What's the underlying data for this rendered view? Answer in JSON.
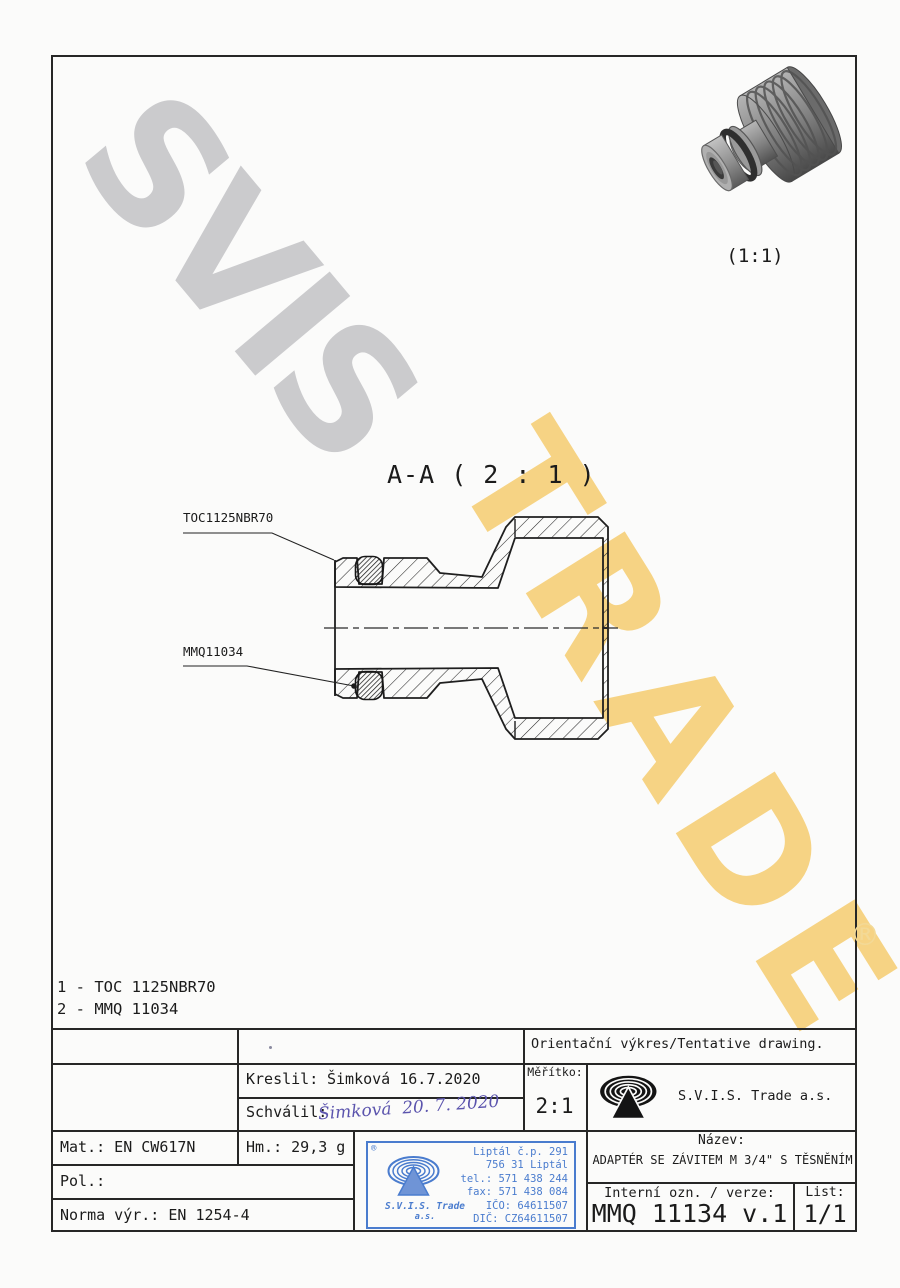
{
  "watermarks": {
    "gray_text": "SVIS",
    "yellow_text": "TRADE",
    "registered": "®",
    "gray_color": "#c7c7ca",
    "yellow_color": "#f6ca67"
  },
  "view3d": {
    "scale_label": "(1:1)"
  },
  "section": {
    "title": "A-A ( 2 : 1 )",
    "callout_top": "TOC1125NBR70",
    "callout_bottom": "MMQ11034"
  },
  "parts_list": {
    "item1": "1 - TOC 1125NBR70",
    "item2": "2 - MMQ 11034"
  },
  "title_block": {
    "note": "Orientační výkres/Tentative drawing.",
    "drawn_label": "Kreslil:",
    "drawn_value": "Šimková 16.7.2020",
    "approved_label": "Schválil:",
    "approved_signature": "Šimková  20. 7. 2020",
    "scale_label": "Měřítko:",
    "scale_value": "2:1",
    "company": "S.V.I.S. Trade a.s.",
    "material": "Mat.: EN CW617N",
    "weight": "Hm.: 29,3 g",
    "position": "Pol.:",
    "standard": "Norma výr.: EN 1254-4",
    "name_label": "Název:",
    "name_value": "ADAPTÉR SE ZÁVITEM M 3/4\" S TĚSNĚNÍM",
    "internal_label": "Interní ozn. / verze:",
    "internal_value": "MMQ 11134 v.1",
    "sheet_label": "List:",
    "sheet_value": "1/1"
  },
  "stamp": {
    "registered": "®",
    "company_line1": "S.V.I.S. Trade",
    "company_line2": "a.s.",
    "address1": "Liptál č.p. 291",
    "address2": "756 31 Liptál",
    "phone": "tel.: 571 438 244",
    "fax": "fax: 571 438 084",
    "ico": "IČO: 64611507",
    "dic": "DIČ: CZ64611507"
  }
}
